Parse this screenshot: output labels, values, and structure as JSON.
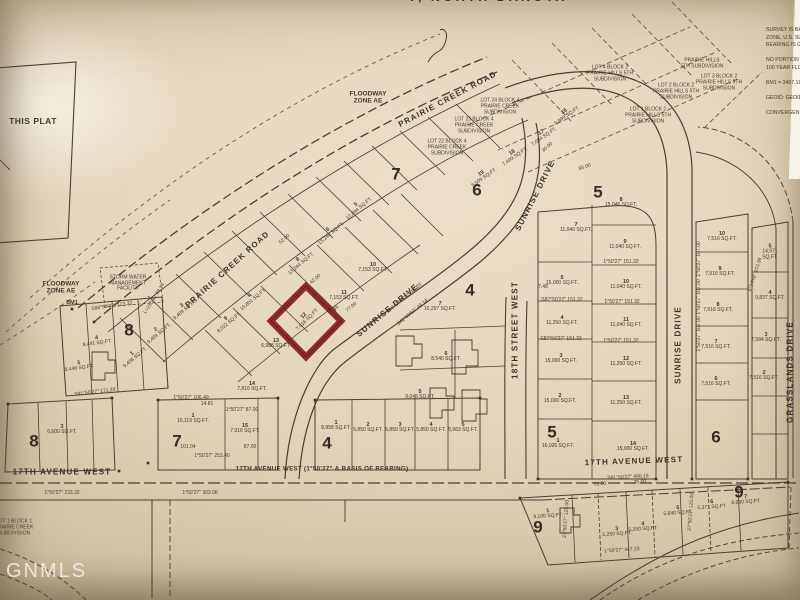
{
  "document": {
    "type": "plat-map-photo",
    "title_partial": "Y, NORTH DAKOTA",
    "watermark": "GNMLS"
  },
  "survey_notes": "SURVEY IS BASE\nZONE, U.S. SUR\nBEARING IS GR\n\nNO PORTION O\n100 YEAR FLOO\n\nBM1 = 3457.18\n\nGEOID: GEOID1\n\nCONVERGEN",
  "highlight": {
    "lot": "12",
    "sqft": "7,016 SQ.FT.",
    "outline_color": "#8b1619"
  },
  "ink_color": "#43392d",
  "paper_color": "#e2d4b8",
  "labels": [
    {
      "t": "PRAIRIE CREEK ROAD",
      "x": 228,
      "y": 270,
      "r": -42,
      "k": "street"
    },
    {
      "t": "PRAIRIE CREEK ROAD",
      "x": 448,
      "y": 100,
      "r": -28,
      "k": "street"
    },
    {
      "t": "SUNRISE DRIVE",
      "x": 388,
      "y": 311,
      "r": -40,
      "k": "street"
    },
    {
      "t": "SUNRISE DRIVE",
      "x": 536,
      "y": 196,
      "r": -63,
      "k": "street"
    },
    {
      "t": "SUNRISE DRIVE",
      "x": 679,
      "y": 345,
      "r": -90,
      "k": "street"
    },
    {
      "t": "18TH STREET WEST",
      "x": 516,
      "y": 330,
      "r": -90,
      "k": "street"
    },
    {
      "t": "GRASSLANDS DRIVE",
      "x": 791,
      "y": 372,
      "r": -90,
      "k": "street"
    },
    {
      "t": "17TH AVENUE WEST",
      "x": 62,
      "y": 473,
      "r": 0,
      "k": "street"
    },
    {
      "t": "17TH AVENUE WEST (1°50'27\" & BASIS OF BEARING)",
      "x": 322,
      "y": 470,
      "r": 0,
      "k": "street2"
    },
    {
      "t": "17TH AVENUE WEST",
      "x": 634,
      "y": 462,
      "r": -2,
      "k": "street"
    },
    {
      "t": "FLOODWAY\nZONE AE",
      "x": 368,
      "y": 98,
      "r": 0,
      "k": "zone"
    },
    {
      "t": "FLOODWAY\nZONE AE",
      "x": 61,
      "y": 288,
      "r": 0,
      "k": "zone"
    },
    {
      "t": "STORM WATER\nMANAGEMENT\nFACILITY",
      "x": 128,
      "y": 284,
      "r": 0,
      "k": "annot"
    },
    {
      "t": "BM1",
      "x": 72,
      "y": 303,
      "r": 0,
      "k": "bm"
    },
    {
      "t": "THIS PLAT",
      "x": 33,
      "y": 122,
      "r": 0,
      "k": "this"
    },
    {
      "t": "7",
      "x": 396,
      "y": 174,
      "r": 0,
      "k": "blocknum"
    },
    {
      "t": "6",
      "x": 477,
      "y": 190,
      "r": 0,
      "k": "blocknum"
    },
    {
      "t": "5",
      "x": 598,
      "y": 192,
      "r": 0,
      "k": "blocknum"
    },
    {
      "t": "4",
      "x": 470,
      "y": 290,
      "r": 0,
      "k": "blocknum"
    },
    {
      "t": "8",
      "x": 129,
      "y": 330,
      "r": 0,
      "k": "blocknum"
    },
    {
      "t": "8",
      "x": 34,
      "y": 441,
      "r": 0,
      "k": "blocknum"
    },
    {
      "t": "7",
      "x": 177,
      "y": 441,
      "r": 0,
      "k": "blocknum"
    },
    {
      "t": "4",
      "x": 327,
      "y": 443,
      "r": 0,
      "k": "blocknum"
    },
    {
      "t": "5",
      "x": 552,
      "y": 432,
      "r": 0,
      "k": "blocknum"
    },
    {
      "t": "6",
      "x": 716,
      "y": 437,
      "r": 0,
      "k": "blocknum"
    },
    {
      "t": "9",
      "x": 538,
      "y": 527,
      "r": 0,
      "k": "blocknum"
    },
    {
      "t": "9",
      "x": 739,
      "y": 492,
      "r": 0,
      "k": "blocknum"
    },
    {
      "t": "12",
      "t2": "7,016 SQ.FT.",
      "x": 306,
      "y": 318,
      "r": -45,
      "k": "lot"
    },
    {
      "t": "11",
      "t2": "7,153 SQ.FT.",
      "x": 344,
      "y": 296,
      "r": 0,
      "k": "lot"
    },
    {
      "t": "13",
      "t2": "6,988 SQ.FT.",
      "x": 276,
      "y": 344,
      "r": 0,
      "k": "lot"
    },
    {
      "t": "10",
      "t2": "7,153 SQ.FT.",
      "x": 373,
      "y": 268,
      "r": 0,
      "k": "lot"
    },
    {
      "t": "8",
      "t2": "13,244 SQ.FT.",
      "x": 300,
      "y": 262,
      "r": -40,
      "k": "lot"
    },
    {
      "t": "4",
      "t2": "10,801 SQ.FT.",
      "x": 252,
      "y": 298,
      "r": -40,
      "k": "lot"
    },
    {
      "t": "6",
      "t2": "13,244 SQ.FT.",
      "x": 330,
      "y": 232,
      "r": -40,
      "k": "lot"
    },
    {
      "t": "5",
      "t2": "12,694 SQ.FT.",
      "x": 358,
      "y": 207,
      "r": -40,
      "k": "lot"
    },
    {
      "t": "9",
      "t2": "8,022 SQ.FT.",
      "x": 228,
      "y": 321,
      "r": -40,
      "k": "lot"
    },
    {
      "t": "3",
      "t2": "9,469 SQ.FT.",
      "x": 184,
      "y": 308,
      "r": -40,
      "k": "lot"
    },
    {
      "t": "2",
      "t2": "9,469 SQ.FT.",
      "x": 158,
      "y": 332,
      "r": -40,
      "k": "lot"
    },
    {
      "t": "1",
      "t2": "9,408 SQ.FT.",
      "x": 134,
      "y": 356,
      "r": -40,
      "k": "lot"
    },
    {
      "t": "16",
      "t2": "9,899 SQ.FT.",
      "x": 566,
      "y": 114,
      "r": -35,
      "k": "lot"
    },
    {
      "t": "17",
      "t2": "7,084 SQ.FT.",
      "x": 543,
      "y": 135,
      "r": -35,
      "k": "lot"
    },
    {
      "t": "18",
      "t2": "7,499 SQ.FT.",
      "x": 514,
      "y": 155,
      "r": -35,
      "k": "lot"
    },
    {
      "t": "19",
      "t2": "8,599 SQ.FT.",
      "x": 483,
      "y": 176,
      "r": -35,
      "k": "lot"
    },
    {
      "t": "7",
      "t2": "10,297 SQ.FT.",
      "x": 440,
      "y": 307,
      "r": 0,
      "k": "lot"
    },
    {
      "t": "6",
      "t2": "8,540 SQ.FT.",
      "x": 446,
      "y": 357,
      "r": 0,
      "k": "lot"
    },
    {
      "t": "5",
      "t2": "9,048 SQ.FT.",
      "x": 420,
      "y": 395,
      "r": 0,
      "k": "lot"
    },
    {
      "t": "8",
      "t2": "15,046 SQ.FT.",
      "x": 621,
      "y": 203,
      "r": 0,
      "k": "lot"
    },
    {
      "t": "7",
      "t2": "11,040 SQ.FT.",
      "x": 576,
      "y": 228,
      "r": 0,
      "k": "lot"
    },
    {
      "t": "9",
      "t2": "11,040 SQ.FT.",
      "x": 625,
      "y": 245,
      "r": 0,
      "k": "lot"
    },
    {
      "t": "10",
      "t2": "11,040 SQ.FT.",
      "x": 626,
      "y": 285,
      "r": 0,
      "k": "lot"
    },
    {
      "t": "11",
      "t2": "11,040 SQ.FT.",
      "x": 626,
      "y": 323,
      "r": 0,
      "k": "lot"
    },
    {
      "t": "12",
      "t2": "11,250 SQ.FT.",
      "x": 626,
      "y": 362,
      "r": 0,
      "k": "lot"
    },
    {
      "t": "13",
      "t2": "11,250 SQ.FT.",
      "x": 626,
      "y": 401,
      "r": 0,
      "k": "lot"
    },
    {
      "t": "14",
      "t2": "15,900 SQ.FT.",
      "x": 633,
      "y": 447,
      "r": 0,
      "k": "lot"
    },
    {
      "t": "5",
      "t2": "15,000 SQ.FT.",
      "x": 562,
      "y": 281,
      "r": 0,
      "k": "lot"
    },
    {
      "t": "4",
      "t2": "11,250 SQ.FT.",
      "x": 562,
      "y": 321,
      "r": 0,
      "k": "lot"
    },
    {
      "t": "3",
      "t2": "15,000 SQ.FT.",
      "x": 561,
      "y": 359,
      "r": 0,
      "k": "lot"
    },
    {
      "t": "2",
      "t2": "15,000 SQ.FT.",
      "x": 560,
      "y": 399,
      "r": 0,
      "k": "lot"
    },
    {
      "t": "1",
      "t2": "16,026 SQ.FT.",
      "x": 558,
      "y": 444,
      "r": 0,
      "k": "lot"
    },
    {
      "t": "10",
      "t2": "7,516 SQ.FT.",
      "x": 722,
      "y": 237,
      "r": 0,
      "k": "lot"
    },
    {
      "t": "9",
      "t2": "7,516 SQ.FT.",
      "x": 720,
      "y": 272,
      "r": 0,
      "k": "lot"
    },
    {
      "t": "8",
      "t2": "7,516 SQ.FT.",
      "x": 718,
      "y": 308,
      "r": 0,
      "k": "lot"
    },
    {
      "t": "7",
      "t2": "7,516 SQ.FT.",
      "x": 716,
      "y": 345,
      "r": 0,
      "k": "lot"
    },
    {
      "t": "6",
      "t2": "7,516 SQ.FT.",
      "x": 716,
      "y": 382,
      "r": 0,
      "k": "lot"
    },
    {
      "t": "5",
      "t2": "14,971 SQ.FT.",
      "x": 770,
      "y": 252,
      "r": 0,
      "k": "lot"
    },
    {
      "t": "4",
      "t2": "9,837 SQ.FT.",
      "x": 770,
      "y": 296,
      "r": 0,
      "k": "lot"
    },
    {
      "t": "3",
      "t2": "7,584 SQ.FT.",
      "x": 766,
      "y": 338,
      "r": 0,
      "k": "lot"
    },
    {
      "t": "2",
      "t2": "7,516 SQ.FT.",
      "x": 764,
      "y": 376,
      "r": 0,
      "k": "lot"
    },
    {
      "t": "1",
      "t2": "16,119 SQ.FT.",
      "x": 193,
      "y": 419,
      "r": 0,
      "k": "lot"
    },
    {
      "t": "15",
      "t2": "7,916 SQ.FT.",
      "x": 245,
      "y": 429,
      "r": 0,
      "k": "lot"
    },
    {
      "t": "14",
      "t2": "7,816 SQ.FT.",
      "x": 252,
      "y": 387,
      "r": 0,
      "k": "lot"
    },
    {
      "t": "1",
      "t2": "8,958 SQ.FT.",
      "x": 336,
      "y": 426,
      "r": 0,
      "k": "lot"
    },
    {
      "t": "2",
      "t2": "5,850 SQ.FT.",
      "x": 368,
      "y": 428,
      "r": 0,
      "k": "lot"
    },
    {
      "t": "3",
      "t2": "5,850 SQ.FT.",
      "x": 400,
      "y": 428,
      "r": 0,
      "k": "lot"
    },
    {
      "t": "4",
      "t2": "5,850 SQ.FT.",
      "x": 431,
      "y": 428,
      "r": 0,
      "k": "lot"
    },
    {
      "t": "5",
      "t2": "5,963 SQ.FT.",
      "x": 463,
      "y": 428,
      "r": 0,
      "k": "lot"
    },
    {
      "t": "3",
      "t2": "6,600 SQ.FT.",
      "x": 62,
      "y": 430,
      "r": 0,
      "k": "lot"
    },
    {
      "t": "4",
      "t2": "8,441 SQ.FT.",
      "x": 97,
      "y": 341,
      "r": -8,
      "k": "lot"
    },
    {
      "t": "3",
      "t2": "8,448 SQ.FT.",
      "x": 79,
      "y": 366,
      "r": -8,
      "k": "lot"
    },
    {
      "t": "1",
      "t2": "9,100 SQ.FT.",
      "x": 548,
      "y": 514,
      "r": -4,
      "k": "lot"
    },
    {
      "t": "3",
      "t2": "5,250 SQ.FT.",
      "x": 617,
      "y": 532,
      "r": -4,
      "k": "lot"
    },
    {
      "t": "4",
      "t2": "5,250 SQ.FT.",
      "x": 643,
      "y": 527,
      "r": -4,
      "k": "lot"
    },
    {
      "t": "5",
      "t2": "5,640 SQ.FT.",
      "x": 678,
      "y": 511,
      "r": -4,
      "k": "lot"
    },
    {
      "t": "6",
      "t2": "5,371 SQ.FT.",
      "x": 712,
      "y": 505,
      "r": -4,
      "k": "lot"
    },
    {
      "t": "7",
      "t2": "6,830 SQ.FT.",
      "x": 746,
      "y": 500,
      "r": -4,
      "k": "lot"
    },
    {
      "t": "1°50'27\" 151.32",
      "x": 621,
      "y": 263,
      "r": 0,
      "k": "dim"
    },
    {
      "t": "1°50'27\" 151.32",
      "x": 622,
      "y": 303,
      "r": 0,
      "k": "dim"
    },
    {
      "t": "1°50'27\" 151.32",
      "x": 621,
      "y": 342,
      "r": 0,
      "k": "dim"
    },
    {
      "t": "S87°50'27\" 151.32",
      "x": 562,
      "y": 301,
      "r": 0,
      "k": "dim"
    },
    {
      "t": "S87°50'27\" 151.32",
      "x": 561,
      "y": 340,
      "r": 0,
      "k": "dim"
    },
    {
      "t": "1°50'27\" 107.00",
      "x": 700,
      "y": 259,
      "r": -90,
      "k": "dim"
    },
    {
      "t": "1°50'27\" 107.00",
      "x": 700,
      "y": 297,
      "r": -90,
      "k": "dim"
    },
    {
      "t": "1°50'27\" 107.00",
      "x": 700,
      "y": 334,
      "r": -90,
      "k": "dim"
    },
    {
      "t": "9°34'48\" 103.36",
      "x": 756,
      "y": 275,
      "r": -72,
      "k": "dim"
    },
    {
      "t": "1°50'27\" 106.49",
      "x": 191,
      "y": 399,
      "r": 0,
      "k": "dim"
    },
    {
      "t": "1°50'27\" 87.00",
      "x": 242,
      "y": 411,
      "r": 0,
      "k": "dim"
    },
    {
      "t": "1°50'27\" 253.40",
      "x": 212,
      "y": 457,
      "r": 0,
      "k": "dim"
    },
    {
      "t": "101.04",
      "x": 188,
      "y": 448,
      "r": 0,
      "k": "dim"
    },
    {
      "t": "87.00",
      "x": 250,
      "y": 448,
      "r": 0,
      "k": "dim"
    },
    {
      "t": "14.81",
      "x": 207,
      "y": 405,
      "r": 0,
      "k": "dim"
    },
    {
      "t": "S47°09'52\" 42.63",
      "x": 407,
      "y": 297,
      "r": -40,
      "k": "dim"
    },
    {
      "t": "S42°09'52\" 44.14",
      "x": 413,
      "y": 313,
      "r": -40,
      "k": "dim"
    },
    {
      "t": "77.00",
      "x": 352,
      "y": 308,
      "r": -40,
      "k": "dim"
    },
    {
      "t": "42.00",
      "x": 316,
      "y": 280,
      "r": -40,
      "k": "dim"
    },
    {
      "t": "17.36",
      "x": 334,
      "y": 311,
      "r": -40,
      "k": "dim"
    },
    {
      "t": "52.00",
      "x": 285,
      "y": 240,
      "r": -40,
      "k": "dim"
    },
    {
      "t": "7.48",
      "x": 543,
      "y": 288,
      "r": 0,
      "k": "dim"
    },
    {
      "t": "S81°50'27\" 480.15",
      "x": 628,
      "y": 478,
      "r": -3,
      "k": "dim"
    },
    {
      "t": "1°50'27\" 447.23",
      "x": 622,
      "y": 551,
      "r": -4,
      "k": "dim"
    },
    {
      "t": "27°50'27\" 125.00",
      "x": 567,
      "y": 519,
      "r": -86,
      "k": "dim"
    },
    {
      "t": "27°50'27\" 125.00",
      "x": 692,
      "y": 512,
      "r": -86,
      "k": "dim"
    },
    {
      "t": "S88°58'03\" 123.32",
      "x": 112,
      "y": 307,
      "r": -8,
      "k": "dim"
    },
    {
      "t": "L=215.87 69.14",
      "x": 155,
      "y": 299,
      "r": -58,
      "k": "dim"
    },
    {
      "t": "S81°50'27\" 171.29",
      "x": 95,
      "y": 393,
      "r": -7,
      "k": "dim"
    },
    {
      "t": "1°50'27\" 233.32",
      "x": 62,
      "y": 494,
      "r": 0,
      "k": "dim"
    },
    {
      "t": "1°50'27\" 303.06",
      "x": 200,
      "y": 494,
      "r": 0,
      "k": "dim"
    },
    {
      "t": "85.00",
      "x": 585,
      "y": 168,
      "r": -18,
      "k": "dim"
    },
    {
      "t": "30.00",
      "x": 548,
      "y": 148,
      "r": -42,
      "k": "dim"
    },
    {
      "t": "72.00",
      "x": 600,
      "y": 485,
      "r": -4,
      "k": "dim"
    },
    {
      "t": "75.00",
      "x": 640,
      "y": 483,
      "r": -4,
      "k": "dim"
    },
    {
      "t": "LOT 24 BLOCK 4\nPRAIRIE CREEK\nSUBDIVISION",
      "x": 500,
      "y": 107,
      "r": 0,
      "k": "adj"
    },
    {
      "t": "LOT 23 BLOCK 4\nPRAIRIE CREEK\nSUBDIVISION",
      "x": 474,
      "y": 126,
      "r": 0,
      "k": "adj"
    },
    {
      "t": "LOT 22 BLOCK 4\nPRAIRIE CREEK\nSUBDIVISION",
      "x": 447,
      "y": 148,
      "r": 0,
      "k": "adj"
    },
    {
      "t": "LOT 4 BLOCK 2\nPRAIRIE HILLS 5TH\nSUBDIVISION",
      "x": 610,
      "y": 74,
      "r": 0,
      "k": "adj"
    },
    {
      "t": "LOT 2 BLOCK 2\nPRAIRIE HILLS 5TH\nSUBDIVISION",
      "x": 676,
      "y": 92,
      "r": 0,
      "k": "adj"
    },
    {
      "t": "LOT 3 BLOCK 2\nPRAIRIE HILLS 5TH\nSUBDIVISION",
      "x": 719,
      "y": 83,
      "r": 0,
      "k": "adj"
    },
    {
      "t": "LOT 1 BLOCK 2\nPRAIRIE HILLS 5TH\nSUBDIVISION",
      "x": 648,
      "y": 116,
      "r": 0,
      "k": "adj"
    },
    {
      "t": "PRAIRIE HILLS\n5TH SUBDIVISION",
      "x": 702,
      "y": 64,
      "r": 0,
      "k": "adj"
    },
    {
      "t": "LOT 1 BLOCK 1\nPRAIRIE CREEK\nSUBDIVISION",
      "x": 14,
      "y": 528,
      "r": 0,
      "k": "adj"
    }
  ]
}
